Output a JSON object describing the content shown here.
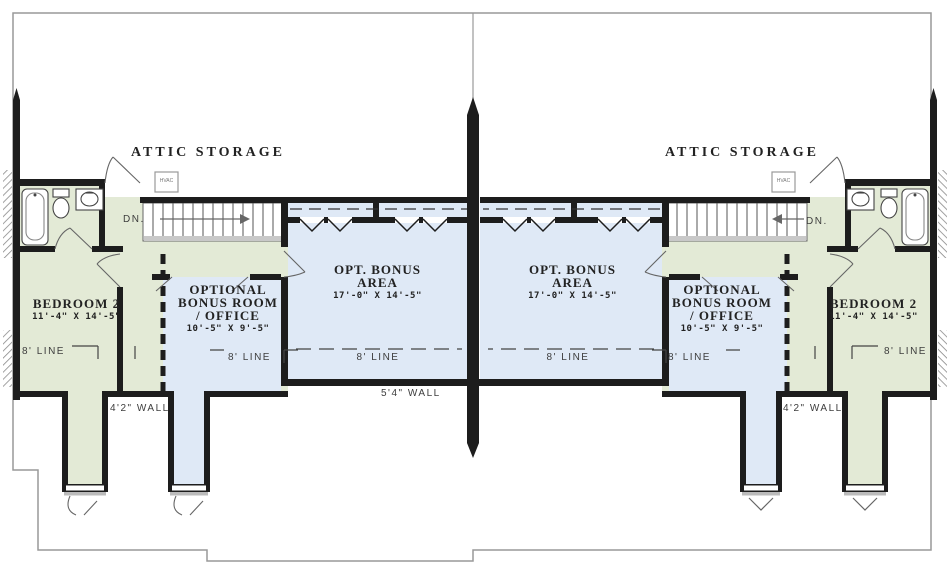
{
  "drawing": {
    "type": "duplex-second-floor-plan",
    "colors": {
      "room_green": "#e3ead6",
      "room_blue": "#dfe9f6",
      "wall": "#1d1d1d",
      "roofline": "#999999",
      "stair_edge": "#c8c8c8",
      "label_text": "#3d3d3d"
    }
  },
  "left_unit": {
    "attic_label": "ATTIC STORAGE",
    "hvac_label": "HVAC",
    "stairs_label": "DN.",
    "bedroom": {
      "name": "BEDROOM 2",
      "dims": "11'-4\" X 14'-5\"",
      "line_label": "8' LINE"
    },
    "bonus_room": {
      "line1": "OPTIONAL",
      "line2": "BONUS ROOM",
      "line3": "/ OFFICE",
      "dims": "10'-5\" X 9'-5\"",
      "line_label": "8' LINE"
    },
    "bonus_area": {
      "line1": "OPT. BONUS",
      "line2": "AREA",
      "dims": "17'-0\" X 14'-5\"",
      "line_label": "8' LINE"
    },
    "knee_wall_label": "4'2\" WALL",
    "party_wall_label": "5'4\" WALL"
  },
  "right_unit": {
    "attic_label": "ATTIC STORAGE",
    "hvac_label": "HVAC",
    "stairs_label": "DN.",
    "bedroom": {
      "name": "BEDROOM 2",
      "dims": "11'-4\" X 14'-5\"",
      "line_label": "8' LINE"
    },
    "bonus_room": {
      "line1": "OPTIONAL",
      "line2": "BONUS ROOM",
      "line3": "/ OFFICE",
      "dims": "10'-5\" X 9'-5\"",
      "line_label": "8' LINE"
    },
    "bonus_area": {
      "line1": "OPT. BONUS",
      "line2": "AREA",
      "dims": "17'-0\" X 14'-5\"",
      "line_label": "8' LINE"
    },
    "knee_wall_label": "4'2\" WALL"
  }
}
